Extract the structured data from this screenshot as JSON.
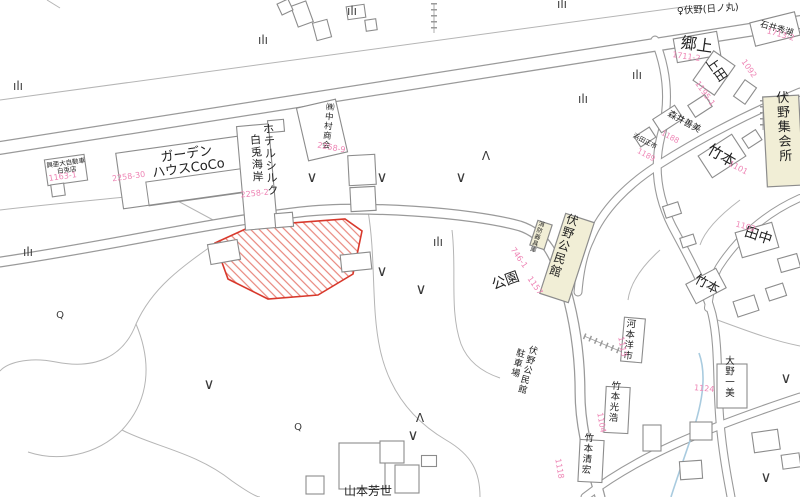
{
  "map": {
    "type": "japanese-residential-cadastral-map",
    "colors": {
      "road_casing": "#9a9a9a",
      "parcel_line": "#b5b5b5",
      "building_stroke": "#8c8c8c",
      "public_building_fill": "#f1eed6",
      "highlight_stroke": "#d8392c",
      "highlight_hatch": "#e8867c",
      "lot_number_pink": "#ee85b5",
      "label_black": "#222222",
      "water_blue": "#a9cbdf"
    },
    "labels": {
      "black": [
        {
          "id": "label-garden-house-coco",
          "lines": [
            "ガーデン",
            "ハウスCoCo"
          ],
          "x": 187,
          "y": 158,
          "rot": -8,
          "size": 13
        },
        {
          "id": "label-hotel-silk-hakuto",
          "orient": "v",
          "cols": [
            {
              "t": "ホテルシルク",
              "dy": 0
            },
            {
              "t": "白兎海岸",
              "dy": 10
            }
          ],
          "x": 262,
          "y": 133,
          "rot": -4,
          "size": 11
        },
        {
          "id": "label-nakamura-shokai",
          "orient": "v",
          "cols": [
            {
              "t": "㈱中村商会",
              "dy": 0
            }
          ],
          "x": 330,
          "y": 110,
          "rot": 6,
          "size": 8.5
        },
        {
          "id": "label-koa-hakuto",
          "lines": [
            "興亜大自動車",
            "白兎店"
          ],
          "x": 66,
          "y": 165,
          "rot": -8,
          "size": 6.5
        },
        {
          "id": "label-busstop-fushino-hinomaru",
          "text": "♀伏野(日ノ丸)",
          "x": 708,
          "y": 12,
          "rot": -4,
          "size": 9.5
        },
        {
          "id": "label-gojo",
          "text": "郷上",
          "x": 696,
          "y": 50,
          "rot": 8,
          "size": 16
        },
        {
          "id": "label-ishii-hideko",
          "text": "石井秀湖",
          "x": 776,
          "y": 31,
          "rot": 16,
          "size": 8.5
        },
        {
          "id": "label-ueda",
          "text": "上田",
          "x": 713,
          "y": 72,
          "rot": 55,
          "size": 13
        },
        {
          "id": "label-morii-yoshimi",
          "text": "森井善美",
          "x": 683,
          "y": 124,
          "rot": 28,
          "size": 9
        },
        {
          "id": "label-hamada-masaichi",
          "text": "浜田正市",
          "x": 644,
          "y": 143,
          "rot": 28,
          "size": 6.5
        },
        {
          "id": "label-takemoto-1",
          "text": "竹本",
          "x": 719,
          "y": 160,
          "rot": 30,
          "size": 15
        },
        {
          "id": "label-fushino-shukaijo",
          "orient": "v",
          "cols": [
            {
              "t": "伏野集会所",
              "dy": 0
            }
          ],
          "x": 783,
          "y": 102,
          "rot": -3,
          "size": 13
        },
        {
          "id": "label-tanaka",
          "text": "田中",
          "x": 757,
          "y": 240,
          "rot": 18,
          "size": 14
        },
        {
          "id": "label-takemoto-2",
          "text": "竹本",
          "x": 705,
          "y": 288,
          "rot": 28,
          "size": 13
        },
        {
          "id": "label-kouen",
          "text": "公園",
          "x": 507,
          "y": 285,
          "rot": -20,
          "size": 14
        },
        {
          "id": "label-fushino-kouminkan",
          "orient": "v",
          "cols": [
            {
              "t": "伏野公民館",
              "dy": 0
            }
          ],
          "x": 571,
          "y": 224,
          "rot": 18,
          "size": 12
        },
        {
          "id": "label-shobo-kigu-ko",
          "orient": "v",
          "cols": [
            {
              "t": "消防器具庫",
              "dy": 0
            }
          ],
          "x": 541,
          "y": 226,
          "rot": 18,
          "size": 6
        },
        {
          "id": "label-kouminkan-parking",
          "orient": "v",
          "cols": [
            {
              "t": "伏野公民館",
              "dy": 0
            },
            {
              "t": "駐車場",
              "dy": 6
            }
          ],
          "x": 527,
          "y": 352,
          "rot": 15,
          "size": 9
        },
        {
          "id": "label-kawamoto-yoichi",
          "orient": "v",
          "cols": [
            {
              "t": "河本洋市",
              "dy": 0
            }
          ],
          "x": 631,
          "y": 327,
          "rot": 6,
          "size": 9.5
        },
        {
          "id": "label-takemoto-mitsuhiro",
          "orient": "v",
          "cols": [
            {
              "t": "竹本光浩",
              "dy": 0
            }
          ],
          "x": 616,
          "y": 389,
          "rot": 5,
          "size": 9.5
        },
        {
          "id": "label-takemoto-kiyohiro",
          "orient": "v",
          "cols": [
            {
              "t": "竹本清宏",
              "dy": 0
            }
          ],
          "x": 589,
          "y": 441,
          "rot": 5,
          "size": 9.5
        },
        {
          "id": "label-ohno-kazumi",
          "orient": "v",
          "cols": [
            {
              "t": "大野一美",
              "dy": 0
            }
          ],
          "x": 730,
          "y": 364,
          "rot": 0,
          "size": 9.5
        },
        {
          "id": "label-yamamoto-yoshiyo",
          "text": "山本芳世",
          "x": 368,
          "y": 495,
          "rot": 0,
          "size": 12
        }
      ],
      "pink": [
        {
          "id": "lot-1163-1",
          "text": "1163-1",
          "x": 63,
          "y": 179,
          "rot": -8,
          "size": 8
        },
        {
          "id": "lot-2258-30",
          "text": "2258-30",
          "x": 129,
          "y": 179,
          "rot": -8,
          "size": 8
        },
        {
          "id": "lot-2258-2",
          "text": "2258-2",
          "x": 255,
          "y": 196,
          "rot": -6,
          "size": 8
        },
        {
          "id": "lot-2258-9",
          "text": "2258-9",
          "x": 331,
          "y": 150,
          "rot": 10,
          "size": 8
        },
        {
          "id": "lot-1711-2",
          "text": "1711-2",
          "x": 686,
          "y": 59,
          "rot": 8,
          "size": 8
        },
        {
          "id": "lot-1713-2",
          "text": "1713-2",
          "x": 780,
          "y": 37,
          "rot": 16,
          "size": 8
        },
        {
          "id": "lot-1092",
          "text": "1092",
          "x": 747,
          "y": 70,
          "rot": 55,
          "size": 8
        },
        {
          "id": "lot-1195-1",
          "text": "1195-1",
          "x": 703,
          "y": 95,
          "rot": 55,
          "size": 8
        },
        {
          "id": "lot-1188",
          "text": "1188",
          "x": 669,
          "y": 139,
          "rot": 28,
          "size": 7.5
        },
        {
          "id": "lot-1189",
          "text": "1189",
          "x": 645,
          "y": 157,
          "rot": 28,
          "size": 7.5
        },
        {
          "id": "lot-1101",
          "text": "1101",
          "x": 737,
          "y": 170,
          "rot": 28,
          "size": 8
        },
        {
          "id": "lot-1102",
          "text": "1102",
          "x": 745,
          "y": 229,
          "rot": 15,
          "size": 8
        },
        {
          "id": "lot-746-1",
          "text": "746-1",
          "x": 517,
          "y": 259,
          "rot": 55,
          "size": 8
        },
        {
          "id": "lot-1157",
          "text": "1157",
          "x": 533,
          "y": 287,
          "rot": 55,
          "size": 8
        },
        {
          "id": "lot-1104",
          "text": "1104",
          "x": 599,
          "y": 423,
          "rot": 80,
          "size": 8
        },
        {
          "id": "lot-1118",
          "text": "1118",
          "x": 557,
          "y": 469,
          "rot": 80,
          "size": 8
        },
        {
          "id": "lot-1124",
          "text": "1124",
          "x": 704,
          "y": 391,
          "rot": 5,
          "size": 8
        },
        {
          "id": "lot-1113",
          "text": "1113",
          "x": 620,
          "y": 347,
          "rot": 80,
          "size": 8
        }
      ]
    },
    "symbols": {
      "glyphs": {
        "paddy": "ılı",
        "chevron": "∨",
        "conifer": "Λ",
        "pole": "Q"
      },
      "sizes": {
        "paddy": 12,
        "chevron": 15,
        "conifer": 12,
        "pole": 10
      },
      "color": "#3a3a3a",
      "items": [
        {
          "g": "paddy",
          "x": 263,
          "y": 44
        },
        {
          "g": "paddy",
          "x": 18,
          "y": 90
        },
        {
          "g": "paddy",
          "x": 28,
          "y": 256
        },
        {
          "g": "paddy",
          "x": 438,
          "y": 246
        },
        {
          "g": "paddy",
          "x": 562,
          "y": 8
        },
        {
          "g": "paddy",
          "x": 637,
          "y": 79
        },
        {
          "g": "paddy",
          "x": 583,
          "y": 103
        },
        {
          "g": "paddy",
          "x": 352,
          "y": 15
        },
        {
          "g": "chevron",
          "x": 312,
          "y": 182
        },
        {
          "g": "chevron",
          "x": 382,
          "y": 182
        },
        {
          "g": "chevron",
          "x": 461,
          "y": 182
        },
        {
          "g": "chevron",
          "x": 382,
          "y": 276
        },
        {
          "g": "chevron",
          "x": 421,
          "y": 294
        },
        {
          "g": "chevron",
          "x": 209,
          "y": 389
        },
        {
          "g": "chevron",
          "x": 413,
          "y": 440
        },
        {
          "g": "chevron",
          "x": 786,
          "y": 383
        },
        {
          "g": "chevron",
          "x": 766,
          "y": 482
        },
        {
          "g": "conifer",
          "x": 486,
          "y": 160
        },
        {
          "g": "conifer",
          "x": 420,
          "y": 422
        },
        {
          "g": "pole",
          "x": 60,
          "y": 318
        },
        {
          "g": "pole",
          "x": 298,
          "y": 430
        }
      ]
    },
    "highlight_parcel": {
      "description": "subject lot outlined in red with red diagonal hatching",
      "points": "215,243 252,226 345,219 362,231 353,274 318,295 268,299 228,279"
    }
  }
}
